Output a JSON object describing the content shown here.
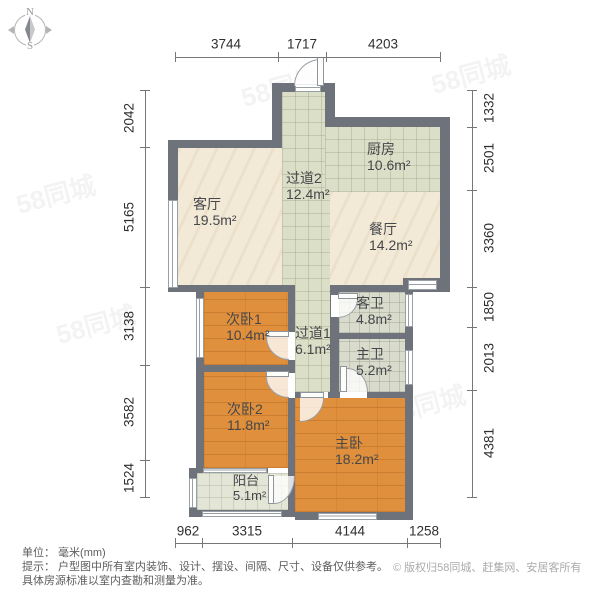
{
  "compass": {
    "north": "N",
    "south": "S"
  },
  "rooms": [
    {
      "id": "living",
      "name": "客厅",
      "area": "19.5m²"
    },
    {
      "id": "corridor2",
      "name": "过道2",
      "area": "12.4m²"
    },
    {
      "id": "kitchen",
      "name": "厨房",
      "area": "10.6m²"
    },
    {
      "id": "dining",
      "name": "餐厅",
      "area": "14.2m²"
    },
    {
      "id": "bedroom1",
      "name": "次卧1",
      "area": "10.4m²"
    },
    {
      "id": "corridor1",
      "name": "过道1",
      "area": "6.1m²"
    },
    {
      "id": "guest_bath",
      "name": "客卫",
      "area": "4.8m²"
    },
    {
      "id": "master_bath",
      "name": "主卫",
      "area": "5.2m²"
    },
    {
      "id": "bedroom2",
      "name": "次卧2",
      "area": "11.8m²"
    },
    {
      "id": "master",
      "name": "主卧",
      "area": "18.2m²"
    },
    {
      "id": "balcony",
      "name": "阳台",
      "area": "5.1m²"
    }
  ],
  "dimensions": {
    "top": [
      "3744",
      "1717",
      "4203"
    ],
    "left": [
      "2042",
      "5165",
      "3138",
      "3582",
      "1524"
    ],
    "right": [
      "1332",
      "2501",
      "3360",
      "1850",
      "2013",
      "4381"
    ],
    "bottom": [
      "962",
      "3315",
      "4144",
      "1258"
    ]
  },
  "footer": {
    "unit": "单位： 毫米(mm)",
    "note1": "提示： 户型图中所有室内装饰、设计、摆设、间隔、尺寸、设备仅供参考。",
    "note2": "具体房源标准以室内查勘和测量为准。",
    "copyright": "© 版权归58同城、赶集网、安居客所有"
  },
  "watermark": "58同城",
  "colors": {
    "wall": "#6e727b",
    "floor_wood": "#e0903c",
    "floor_cream": "#f2e9d7",
    "floor_tile": "#dcdfc8",
    "floor_bath": "#d9dccd",
    "floor_balcony": "#e3e5d6"
  }
}
